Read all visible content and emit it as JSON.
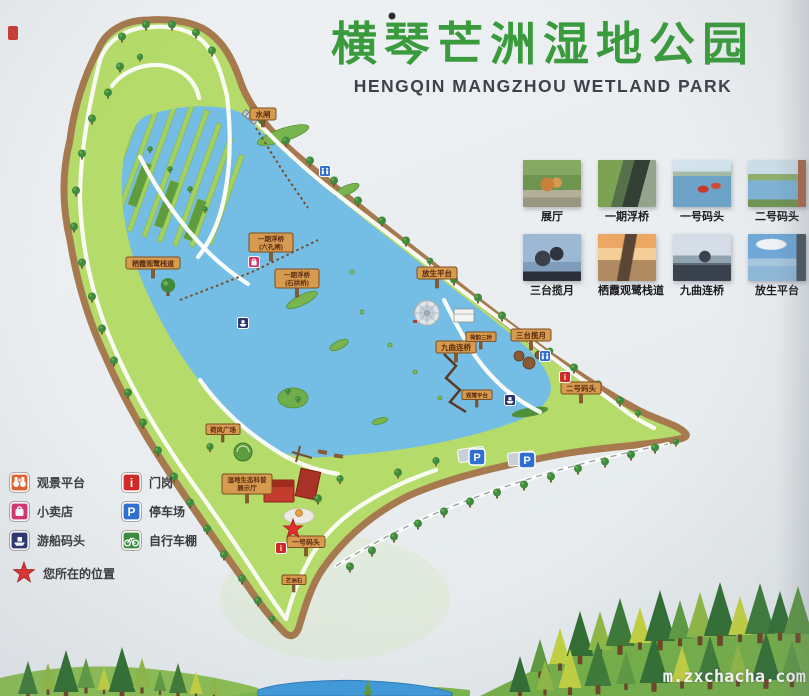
{
  "header": {
    "title_zh": "横琴芒洲湿地公园",
    "title_en": "HENGQIN MANGZHOU WETLAND PARK"
  },
  "photos": {
    "items": [
      {
        "caption": "展厅"
      },
      {
        "caption": "一期浮桥"
      },
      {
        "caption": "一号码头"
      },
      {
        "caption": "二号码头"
      },
      {
        "caption": "三台揽月"
      },
      {
        "caption": "栖霞观鹭栈道"
      },
      {
        "caption": "九曲连桥"
      },
      {
        "caption": "放生平台"
      }
    ]
  },
  "legend": {
    "items": [
      {
        "label": "观景平台",
        "icon": "binoculars-icon",
        "color": "#e2622b"
      },
      {
        "label": "小卖店",
        "icon": "shop-bag-icon",
        "color": "#d8336e"
      },
      {
        "label": "游船码头",
        "icon": "boat-icon",
        "color": "#2a3570"
      },
      {
        "label": "门岗",
        "icon": "info-icon",
        "color": "#cf2a27"
      },
      {
        "label": "停车场",
        "icon": "parking-icon",
        "color": "#2f6fd0"
      },
      {
        "label": "自行车棚",
        "icon": "bicycle-icon",
        "color": "#3c8a40"
      }
    ],
    "you_are_here": "您所在的位置"
  },
  "glyphs": {
    "parking": "P",
    "info": "i"
  },
  "map": {
    "signs": [
      {
        "l1": "水闸"
      },
      {
        "l1": "栖霞观鹭栈道"
      },
      {
        "l1": "一期浮桥",
        "l2": "(六孔闸)"
      },
      {
        "l1": "一期浮桥",
        "l2": "(石拱桥)"
      },
      {
        "l1": "放生平台"
      },
      {
        "l1": "九曲连桥"
      },
      {
        "l1": "荷韵三桥"
      },
      {
        "l1": "三台揽月"
      },
      {
        "l1": "二号码头"
      },
      {
        "l1": "观鹭平台"
      },
      {
        "l1": "荷风广场"
      },
      {
        "l1": "湿地生态科普",
        "l2": "展示厅"
      },
      {
        "l1": "一号码头"
      },
      {
        "l1": "芒洲石"
      }
    ]
  },
  "watermark": "m.zxchacha.com",
  "colors": {
    "title_green": "#3a9b3c",
    "subtitle_gray": "#40404a",
    "water_blue": "#74bde4",
    "land_green": "#b5dc6a",
    "shore_brown": "#a6794e",
    "star_red": "#e03030",
    "sign_board": "#d79b50"
  }
}
